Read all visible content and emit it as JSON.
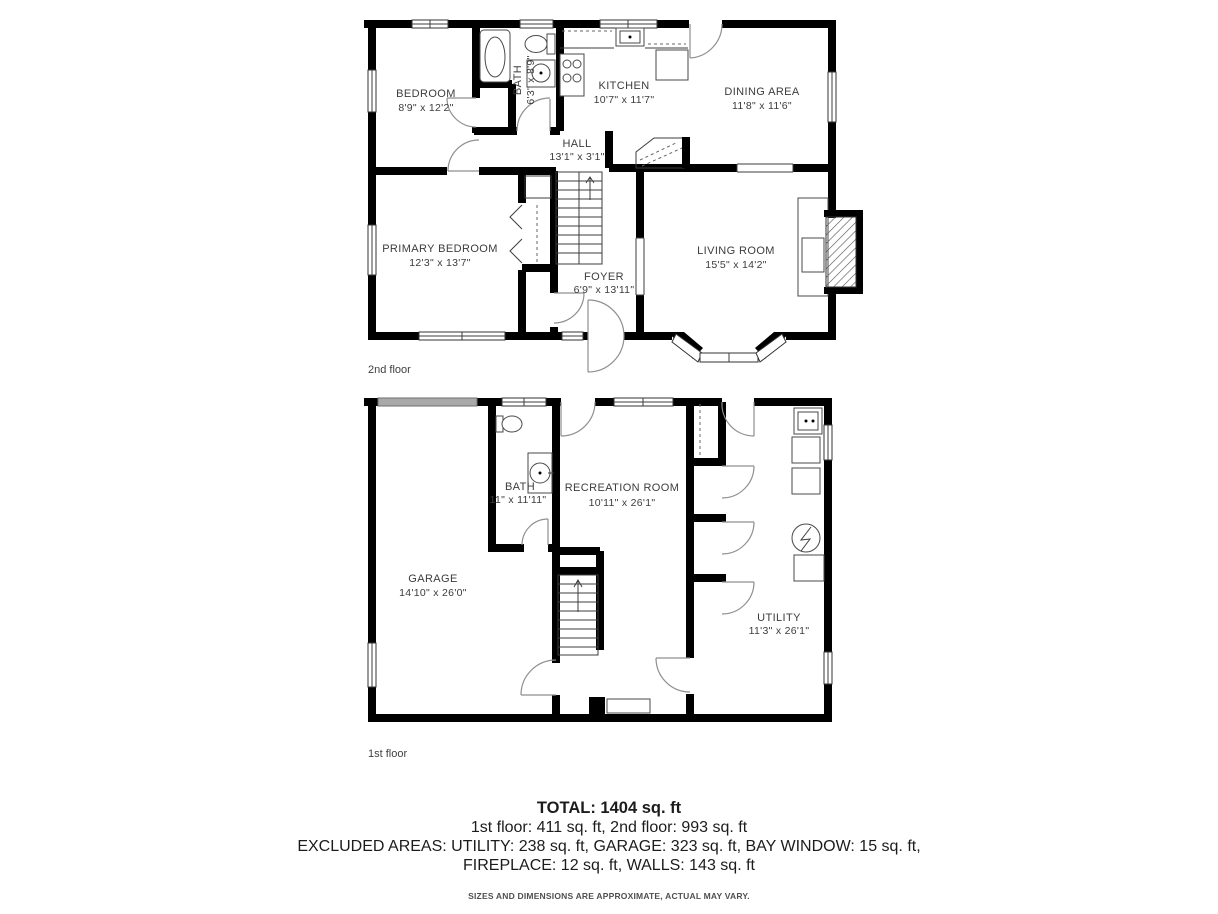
{
  "floor2": {
    "caption": "2nd floor",
    "rooms": {
      "bedroom": {
        "name": "BEDROOM",
        "dims": "8'9\" x 12'2\""
      },
      "bath": {
        "name": "BATH",
        "dims": "6'3\" x 8'9\""
      },
      "kitchen": {
        "name": "KITCHEN",
        "dims": "10'7\" x 11'7\""
      },
      "dining_area": {
        "name": "DINING AREA",
        "dims": "11'8\" x 11'6\""
      },
      "hall": {
        "name": "HALL",
        "dims": "13'1\" x 3'1\""
      },
      "primary_bedroom": {
        "name": "PRIMARY BEDROOM",
        "dims": "12'3\" x 13'7\""
      },
      "foyer": {
        "name": "FOYER",
        "dims": "6'9\" x 13'11\""
      },
      "living_room": {
        "name": "LIVING ROOM",
        "dims": "15'5\" x 14'2\""
      }
    }
  },
  "floor1": {
    "caption": "1st floor",
    "rooms": {
      "bath": {
        "name": "BATH",
        "dims": "11\" x 11'11\""
      },
      "recreation_room": {
        "name": "RECREATION ROOM",
        "dims": "10'11\" x 26'1\""
      },
      "garage": {
        "name": "GARAGE",
        "dims": "14'10\" x 26'0\""
      },
      "utility": {
        "name": "UTILITY",
        "dims": "11'3\" x 26'1\""
      }
    }
  },
  "summary": {
    "total": "TOTAL: 1404 sq. ft",
    "floors": "1st floor: 411 sq. ft, 2nd floor: 993 sq. ft",
    "excluded_line1": "EXCLUDED AREAS: UTILITY: 238 sq. ft, GARAGE: 323 sq. ft, BAY WINDOW: 15 sq. ft,",
    "excluded_line2": "FIREPLACE: 12 sq. ft, WALLS: 143 sq. ft",
    "disclaimer": "SIZES AND DIMENSIONS ARE APPROXIMATE, ACTUAL MAY VARY."
  },
  "colors": {
    "wall": "#000000",
    "text": "#3c3c3c",
    "door_arc": "#8f8f8f",
    "garage_door": "#a9a9a9",
    "summary_text": "#1c1c1c"
  }
}
